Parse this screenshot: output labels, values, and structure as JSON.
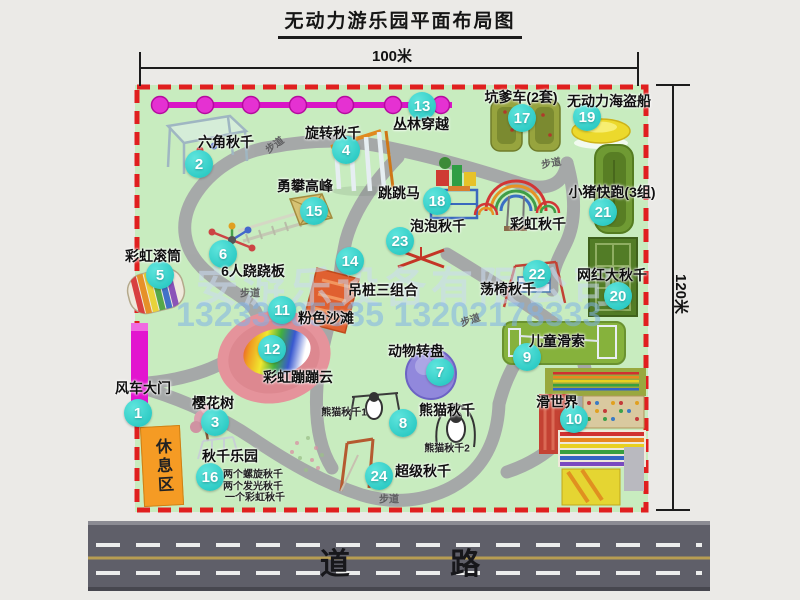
{
  "title": "无动力游乐园平面布局图",
  "dimensions": {
    "width_label": "100米",
    "height_label": "120米"
  },
  "road": {
    "label": "道 路"
  },
  "rest_area": {
    "label": "休息区"
  },
  "watermark": {
    "company": "安游乐设备有限公司",
    "phone": "13233805535 13202178333"
  },
  "colors": {
    "park_green": "#c8ecbf",
    "border_red": "#e01f1f",
    "marker_teal": "#1cc2bc",
    "gate_magenta": "#e215cf",
    "road_gray": "#5f5f69"
  },
  "trail_label_text": "步道",
  "trail_labels": [
    {
      "x": 274,
      "y": 144,
      "rot": -36
    },
    {
      "x": 551,
      "y": 162,
      "rot": -10
    },
    {
      "x": 250,
      "y": 292,
      "rot": 0
    },
    {
      "x": 470,
      "y": 319,
      "rot": -18
    },
    {
      "x": 389,
      "y": 498,
      "rot": 0
    }
  ],
  "attractions": [
    {
      "n": "1",
      "t": "风车大门",
      "m": [
        138,
        413
      ],
      "l": [
        143,
        388
      ]
    },
    {
      "n": "2",
      "t": "六角秋千",
      "m": [
        199,
        164
      ],
      "l": [
        226,
        142
      ]
    },
    {
      "n": "3",
      "t": "樱花树",
      "m": [
        215,
        422
      ],
      "l": [
        213,
        403
      ]
    },
    {
      "n": "4",
      "t": "旋转秋千",
      "m": [
        346,
        150
      ],
      "l": [
        333,
        133
      ]
    },
    {
      "n": "5",
      "t": "彩虹滚筒",
      "m": [
        160,
        275
      ],
      "l": [
        153,
        256
      ]
    },
    {
      "n": "6",
      "t": "6人跷跷板",
      "m": [
        223,
        254
      ],
      "l": [
        253,
        271
      ]
    },
    {
      "n": "7",
      "t": "动物转盘",
      "m": [
        440,
        372
      ],
      "l": [
        416,
        351
      ]
    },
    {
      "n": "8",
      "t": "熊猫秋千",
      "m": [
        403,
        423
      ],
      "l": [
        447,
        410
      ],
      "s": [
        {
          "t": "熊猫秋千1",
          "x": 344,
          "y": 411
        },
        {
          "t": "熊猫秋千2",
          "x": 447,
          "y": 447
        }
      ]
    },
    {
      "n": "9",
      "t": "儿童滑索",
      "m": [
        527,
        357
      ],
      "l": [
        557,
        341
      ]
    },
    {
      "n": "10",
      "t": "滑世界",
      "m": [
        574,
        419
      ],
      "l": [
        557,
        402
      ]
    },
    {
      "n": "11",
      "t": "粉色沙滩",
      "m": [
        282,
        310
      ],
      "l": [
        326,
        318
      ]
    },
    {
      "n": "12",
      "t": "彩虹蹦蹦云",
      "m": [
        272,
        349
      ],
      "l": [
        298,
        377
      ]
    },
    {
      "n": "13",
      "t": "丛林穿越",
      "m": [
        422,
        106
      ],
      "l": [
        421,
        124
      ]
    },
    {
      "n": "14",
      "t": "吊桩三组合",
      "m": [
        350,
        261
      ],
      "l": [
        383,
        290
      ]
    },
    {
      "n": "15",
      "t": "勇攀高峰",
      "m": [
        314,
        211
      ],
      "l": [
        305,
        186
      ]
    },
    {
      "n": "16",
      "t": "秋千乐园",
      "m": [
        210,
        477
      ],
      "l": [
        230,
        456
      ],
      "s": [
        {
          "t": "两个螺旋秋千",
          "x": 253,
          "y": 473
        },
        {
          "t": "两个发光秋千",
          "x": 253,
          "y": 485
        },
        {
          "t": "一个彩虹秋千",
          "x": 255,
          "y": 496
        }
      ]
    },
    {
      "n": "17",
      "t": "坑爹车(2套)",
      "m": [
        522,
        118
      ],
      "l": [
        521,
        97
      ]
    },
    {
      "n": "18",
      "t": "跳跳马",
      "m": [
        437,
        201
      ],
      "l": [
        399,
        193
      ]
    },
    {
      "n": "19",
      "t": "无动力海盗船",
      "m": [
        587,
        117
      ],
      "l": [
        609,
        101
      ]
    },
    {
      "n": "20",
      "t": "网红大秋千",
      "m": [
        618,
        296
      ],
      "l": [
        612,
        275
      ]
    },
    {
      "n": "21",
      "t": "小猪快跑(3组)",
      "m": [
        603,
        212
      ],
      "l": [
        612,
        192
      ]
    },
    {
      "n": "22",
      "t": "荡椅秋千",
      "m": [
        537,
        274
      ],
      "l": [
        508,
        289
      ]
    },
    {
      "n": "23",
      "t": "泡泡秋千",
      "m": [
        400,
        241
      ],
      "l": [
        438,
        226
      ]
    },
    {
      "n": "24",
      "t": "超级秋千",
      "m": [
        379,
        476
      ],
      "l": [
        423,
        471
      ]
    },
    {
      "n": "",
      "t": "彩虹秋千",
      "l": [
        538,
        224
      ]
    }
  ]
}
